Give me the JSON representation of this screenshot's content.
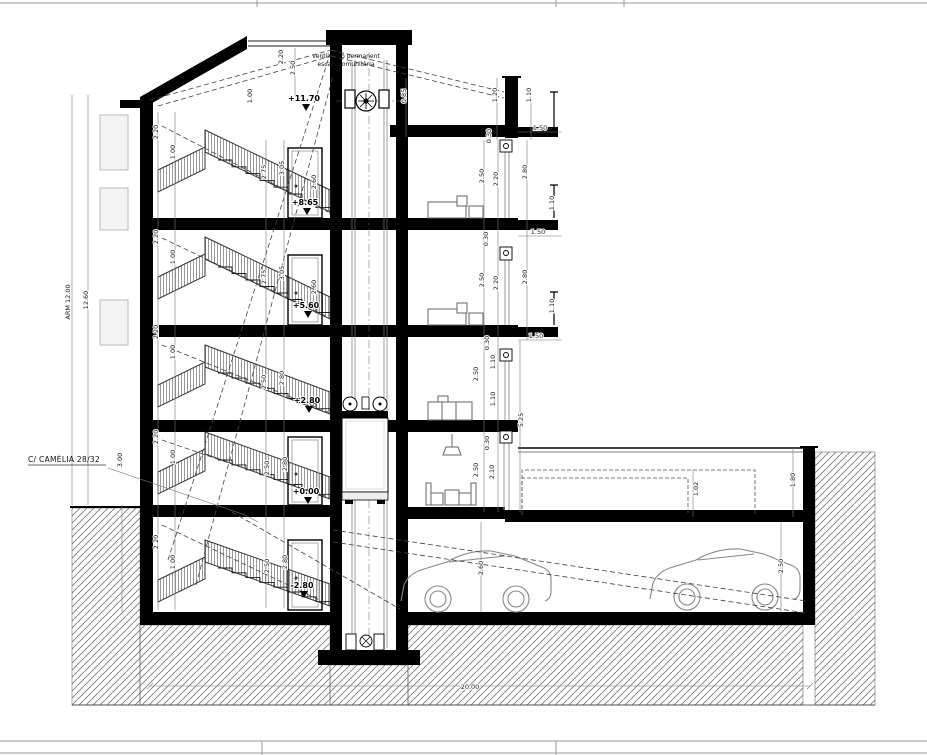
{
  "annotations": {
    "vent_note_line1": "ventil·lació permanent",
    "vent_note_line2": "escala comunitària",
    "street_label": "C/ CAMÈLIA 28/32"
  },
  "levels": [
    {
      "label": "+11.70",
      "x": 304,
      "y": 101
    },
    {
      "label": "+8.65",
      "x": 305,
      "y": 205
    },
    {
      "label": "+5.60",
      "x": 306,
      "y": 308
    },
    {
      "label": "+2.80",
      "x": 307,
      "y": 403
    },
    {
      "label": "+0.00",
      "x": 306,
      "y": 494
    },
    {
      "label": "-2.80",
      "x": 302,
      "y": 588
    }
  ],
  "dim_labels": [
    {
      "t": "ARM 12.00",
      "x": 70,
      "y": 302,
      "o": "v"
    },
    {
      "t": "12.60",
      "x": 88,
      "y": 300,
      "o": "v"
    },
    {
      "t": "3.00",
      "x": 122,
      "y": 460,
      "o": "v"
    },
    {
      "t": "2.50",
      "x": 295,
      "y": 68,
      "o": "v"
    },
    {
      "t": "2.20",
      "x": 283,
      "y": 57,
      "o": "v"
    },
    {
      "t": "1.00",
      "x": 252,
      "y": 96,
      "o": "v"
    },
    {
      "t": "0.85",
      "x": 406,
      "y": 96,
      "o": "v"
    },
    {
      "t": "2.20",
      "x": 158,
      "y": 132,
      "o": "v"
    },
    {
      "t": "2.20",
      "x": 158,
      "y": 237,
      "o": "v"
    },
    {
      "t": "2.20",
      "x": 158,
      "y": 332,
      "o": "v"
    },
    {
      "t": "2.20",
      "x": 158,
      "y": 437,
      "o": "v"
    },
    {
      "t": "2.20",
      "x": 158,
      "y": 542,
      "o": "v"
    },
    {
      "t": "1.00",
      "x": 175,
      "y": 152,
      "o": "v"
    },
    {
      "t": "1.00",
      "x": 175,
      "y": 257,
      "o": "v"
    },
    {
      "t": "1.00",
      "x": 175,
      "y": 352,
      "o": "v"
    },
    {
      "t": "1.00",
      "x": 175,
      "y": 457,
      "o": "v"
    },
    {
      "t": "1.00",
      "x": 175,
      "y": 562,
      "o": "v"
    },
    {
      "t": "2.75",
      "x": 266,
      "y": 172,
      "o": "v"
    },
    {
      "t": "3.05",
      "x": 284,
      "y": 168,
      "o": "v"
    },
    {
      "t": "2.75",
      "x": 266,
      "y": 277,
      "o": "v"
    },
    {
      "t": "3.05",
      "x": 284,
      "y": 273,
      "o": "v"
    },
    {
      "t": "2.50",
      "x": 266,
      "y": 382,
      "o": "v"
    },
    {
      "t": "2.80",
      "x": 284,
      "y": 378,
      "o": "v"
    },
    {
      "t": "2.50",
      "x": 269,
      "y": 468,
      "o": "v"
    },
    {
      "t": "2.80",
      "x": 287,
      "y": 464,
      "o": "v"
    },
    {
      "t": "2.50",
      "x": 269,
      "y": 566,
      "o": "v"
    },
    {
      "t": "2.80",
      "x": 287,
      "y": 562,
      "o": "v"
    },
    {
      "t": "2.60",
      "x": 316,
      "y": 182,
      "o": "v"
    },
    {
      "t": "2.60",
      "x": 316,
      "y": 287,
      "o": "v"
    },
    {
      "t": "1.20",
      "x": 497,
      "y": 95,
      "o": "v"
    },
    {
      "t": "1.10",
      "x": 531,
      "y": 95,
      "o": "v"
    },
    {
      "t": "0.30",
      "x": 491,
      "y": 136,
      "o": "v"
    },
    {
      "t": "1.50",
      "x": 540,
      "y": 130,
      "o": "h"
    },
    {
      "t": "2.50",
      "x": 484,
      "y": 176,
      "o": "v"
    },
    {
      "t": "2.20",
      "x": 498,
      "y": 179,
      "o": "v"
    },
    {
      "t": "2.80",
      "x": 527,
      "y": 172,
      "o": "v"
    },
    {
      "t": "1.10",
      "x": 554,
      "y": 203,
      "o": "v"
    },
    {
      "t": "1.50",
      "x": 538,
      "y": 234,
      "o": "h"
    },
    {
      "t": "0.30",
      "x": 488,
      "y": 239,
      "o": "v"
    },
    {
      "t": "2.50",
      "x": 484,
      "y": 280,
      "o": "v"
    },
    {
      "t": "2.20",
      "x": 498,
      "y": 283,
      "o": "v"
    },
    {
      "t": "2.80",
      "x": 527,
      "y": 277,
      "o": "v"
    },
    {
      "t": "1.10",
      "x": 554,
      "y": 306,
      "o": "v"
    },
    {
      "t": "1.50",
      "x": 536,
      "y": 338,
      "o": "h"
    },
    {
      "t": "0.30",
      "x": 489,
      "y": 343,
      "o": "v"
    },
    {
      "t": "1.10",
      "x": 495,
      "y": 362,
      "o": "v"
    },
    {
      "t": "2.50",
      "x": 478,
      "y": 374,
      "o": "v"
    },
    {
      "t": "1.10",
      "x": 495,
      "y": 399,
      "o": "v"
    },
    {
      "t": "5.25",
      "x": 523,
      "y": 420,
      "o": "v"
    },
    {
      "t": "0.30",
      "x": 489,
      "y": 443,
      "o": "v"
    },
    {
      "t": "2.50",
      "x": 478,
      "y": 470,
      "o": "v"
    },
    {
      "t": "2.10",
      "x": 494,
      "y": 472,
      "o": "v"
    },
    {
      "t": "1.02",
      "x": 698,
      "y": 489,
      "o": "v"
    },
    {
      "t": "1.80",
      "x": 795,
      "y": 480,
      "o": "v"
    },
    {
      "t": "2.50",
      "x": 783,
      "y": 566,
      "o": "v"
    },
    {
      "t": "2.60",
      "x": 483,
      "y": 568,
      "o": "v"
    },
    {
      "t": "20.00",
      "x": 470,
      "y": 689,
      "o": "h"
    }
  ],
  "colors": {
    "background": "#ffffff",
    "wall": "#000000",
    "line": "#1a1a1a",
    "hatch": "#7a7a7a",
    "furniture": "#666666",
    "dashed_guides": "#444444"
  }
}
